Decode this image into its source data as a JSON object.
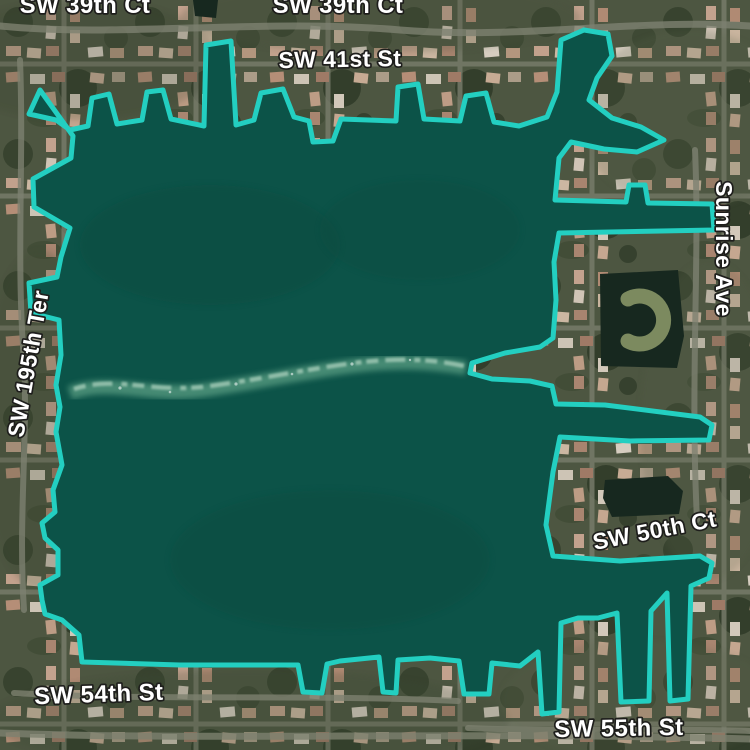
{
  "map": {
    "view": "satellite",
    "palette": {
      "water": "#0c5348",
      "water_dark": "#0a4b41",
      "selection_stroke": "#23cfc1",
      "selection_stroke_width": "5",
      "ground": "#4d5641",
      "road": "#7d8170",
      "pond": "#17281f",
      "island": "#7c8a5f",
      "sediment": "#55997f",
      "sediment_light": "#a9cfbb",
      "label_fill": "#ffffff",
      "label_halo": "#1e1e1c"
    },
    "selection": {
      "feature": "lake-boundary-polygon",
      "path": "M 40 90 L 29 114 L 56 120 L 70 130 L 88 126 L 92 98 L 109 94 L 117 124 L 142 120 L 147 92 L 163 90 L 171 119 L 204 126 L 206 45 L 231 41 L 236 125 L 254 120 L 261 93 L 283 89 L 294 117 L 309 121 L 313 142 L 333 141 L 341 119 L 396 121 L 398 87 L 418 84 L 424 119 L 460 121 L 466 96 L 486 93 L 494 122 L 519 126 L 547 117 L 557 92 L 561 40 L 584 30 L 608 34 L 612 56 L 597 78 L 589 100 L 612 118 L 641 127 L 664 140 L 637 152 L 604 149 L 571 142 L 559 158 L 555 200 L 626 202 L 629 185 L 645 185 L 648 203 L 712 204 L 714 230 L 559 233 L 554 262 L 556 300 L 553 338 L 540 347 L 505 353 L 472 363 L 470 373 L 492 379 L 530 381 L 552 386 L 556 404 L 605 405 L 700 417 L 712 425 L 709 440 L 630 441 L 560 437 L 553 472 L 546 525 L 553 556 L 620 561 L 700 556 L 712 563 L 709 578 L 691 586 L 688 699 L 670 701 L 667 593 L 651 611 L 649 701 L 621 702 L 617 613 L 598 618 L 578 618 L 561 623 L 559 712 L 542 714 L 538 652 L 520 666 L 492 663 L 489 694 L 464 694 L 459 661 L 430 658 L 398 660 L 396 693 L 383 692 L 379 657 L 340 661 L 327 664 L 322 693 L 303 692 L 298 665 L 180 665 L 82 662 L 79 635 L 62 620 L 45 614 L 42 600 L 40 585 L 58 575 L 58 550 L 45 538 L 42 523 L 55 512 L 53 490 L 62 465 L 56 432 L 60 407 L 56 385 L 61 355 L 59 320 L 31 313 L 29 283 L 57 277 L 61 257 L 70 228 L 34 207 L 33 179 L 71 158 L 73 136 Z"
    },
    "water_features": {
      "top_pond": "M 193 0 L 218 0 L 216 18 L 195 16 Z",
      "c_pond": "M 600 274 L 678 270 L 684 336 L 677 368 L 601 366 Z",
      "c_island_arc": "M 628 299 A 24 24 0 1 1 628 341",
      "small_pond": "M 605 480 L 668 476 L 683 491 L 679 514 L 612 517 L 603 498 Z"
    },
    "sediment": {
      "main_path": "M 70 393 C 110 378 150 398 205 390 C 260 382 300 373 345 367 C 395 360 430 362 466 368",
      "highlight_path": "M 74 389 C 115 375 155 394 210 386 C 262 379 302 370 347 364 C 396 357 432 359 464 366"
    },
    "roads": {
      "r_top": "M 0 26 C 120 38 260 18 400 30 C 520 40 640 18 750 26",
      "r_bottom": "M 0 733 C 200 741 480 731 750 739",
      "r_54th": "M 14 693 C 150 701 310 694 458 701",
      "r_55th": "M 468 728 C 560 732 660 728 750 731",
      "r_sunrise": "M 695 150 C 700 260 690 380 697 520",
      "r_195th": "M 20 60 C 24 160 16 260 24 360 C 28 440 18 520 24 610"
    },
    "labels": [
      {
        "text": "SW 39th Ct",
        "x": 85,
        "y": 13,
        "rot": 0,
        "size": 24
      },
      {
        "text": "SW 39th Ct",
        "x": 338,
        "y": 13,
        "rot": 0,
        "size": 24
      },
      {
        "text": "SW 41st St",
        "x": 340,
        "y": 67,
        "rot": -1,
        "size": 23
      },
      {
        "text": "Sunrise Ave",
        "x": 716,
        "y": 249,
        "rot": 90,
        "size": 23
      },
      {
        "text": "SW 195th Ter",
        "x": 36,
        "y": 365,
        "rot": -80,
        "size": 23
      },
      {
        "text": "SW 50th Ct",
        "x": 656,
        "y": 538,
        "rot": -11,
        "size": 23
      },
      {
        "text": "SW 54th St",
        "x": 99,
        "y": 702,
        "rot": -2,
        "size": 24
      },
      {
        "text": "SW 55th St",
        "x": 619,
        "y": 736,
        "rot": -1,
        "size": 24
      }
    ]
  }
}
